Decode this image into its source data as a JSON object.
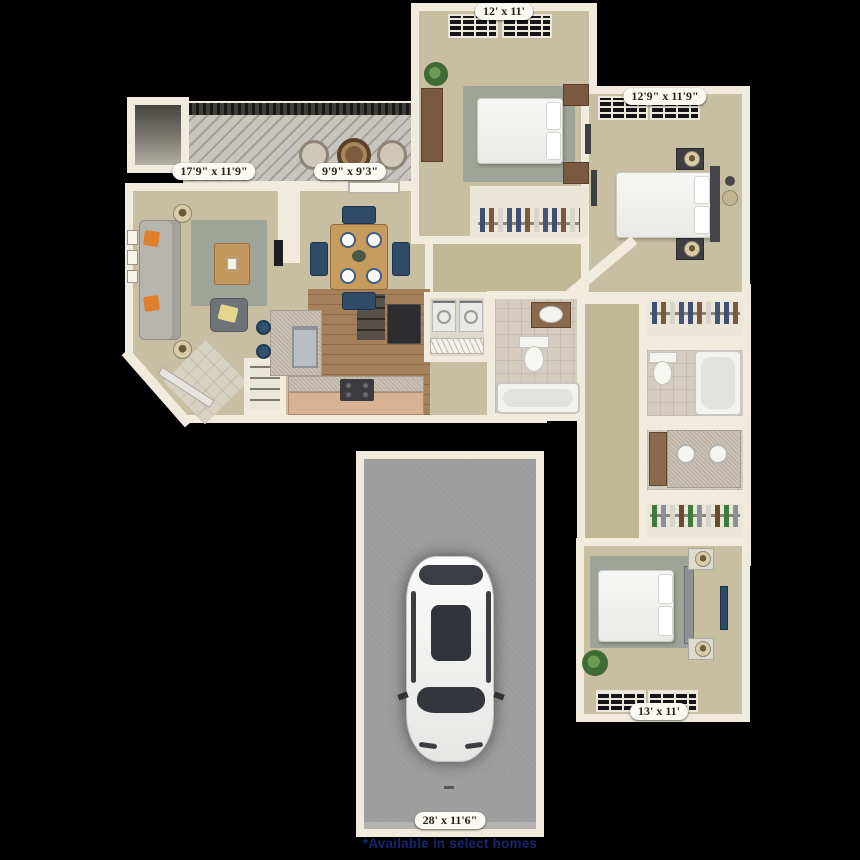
{
  "floorplan": {
    "dimension_labels": {
      "bedroom_top": "12' x 11'",
      "bedroom_right": "12'9\" x 11'9\"",
      "living_room": "17'9\" x 11'9\"",
      "dining_room": "9'9\" x 9'3\"",
      "bedroom_bottom": "13' x 11'",
      "garage": "28' x 11'6\""
    },
    "footnote": "*Available in select homes",
    "colors": {
      "background": "#000000",
      "wall": "#f1ebdd",
      "carpet": "#c8bea1",
      "wood_floor": "#a5815b",
      "bath_tile": "#d4cdbf",
      "garage_floor": "#9d9d9d",
      "deck": "#c8c5be",
      "label_bg": "#fbf9f3",
      "label_text": "#26241f",
      "footnote_text": "#1a246e",
      "accent_pillow": "#e07f2c",
      "dining_chair": "#2f4b68"
    }
  }
}
